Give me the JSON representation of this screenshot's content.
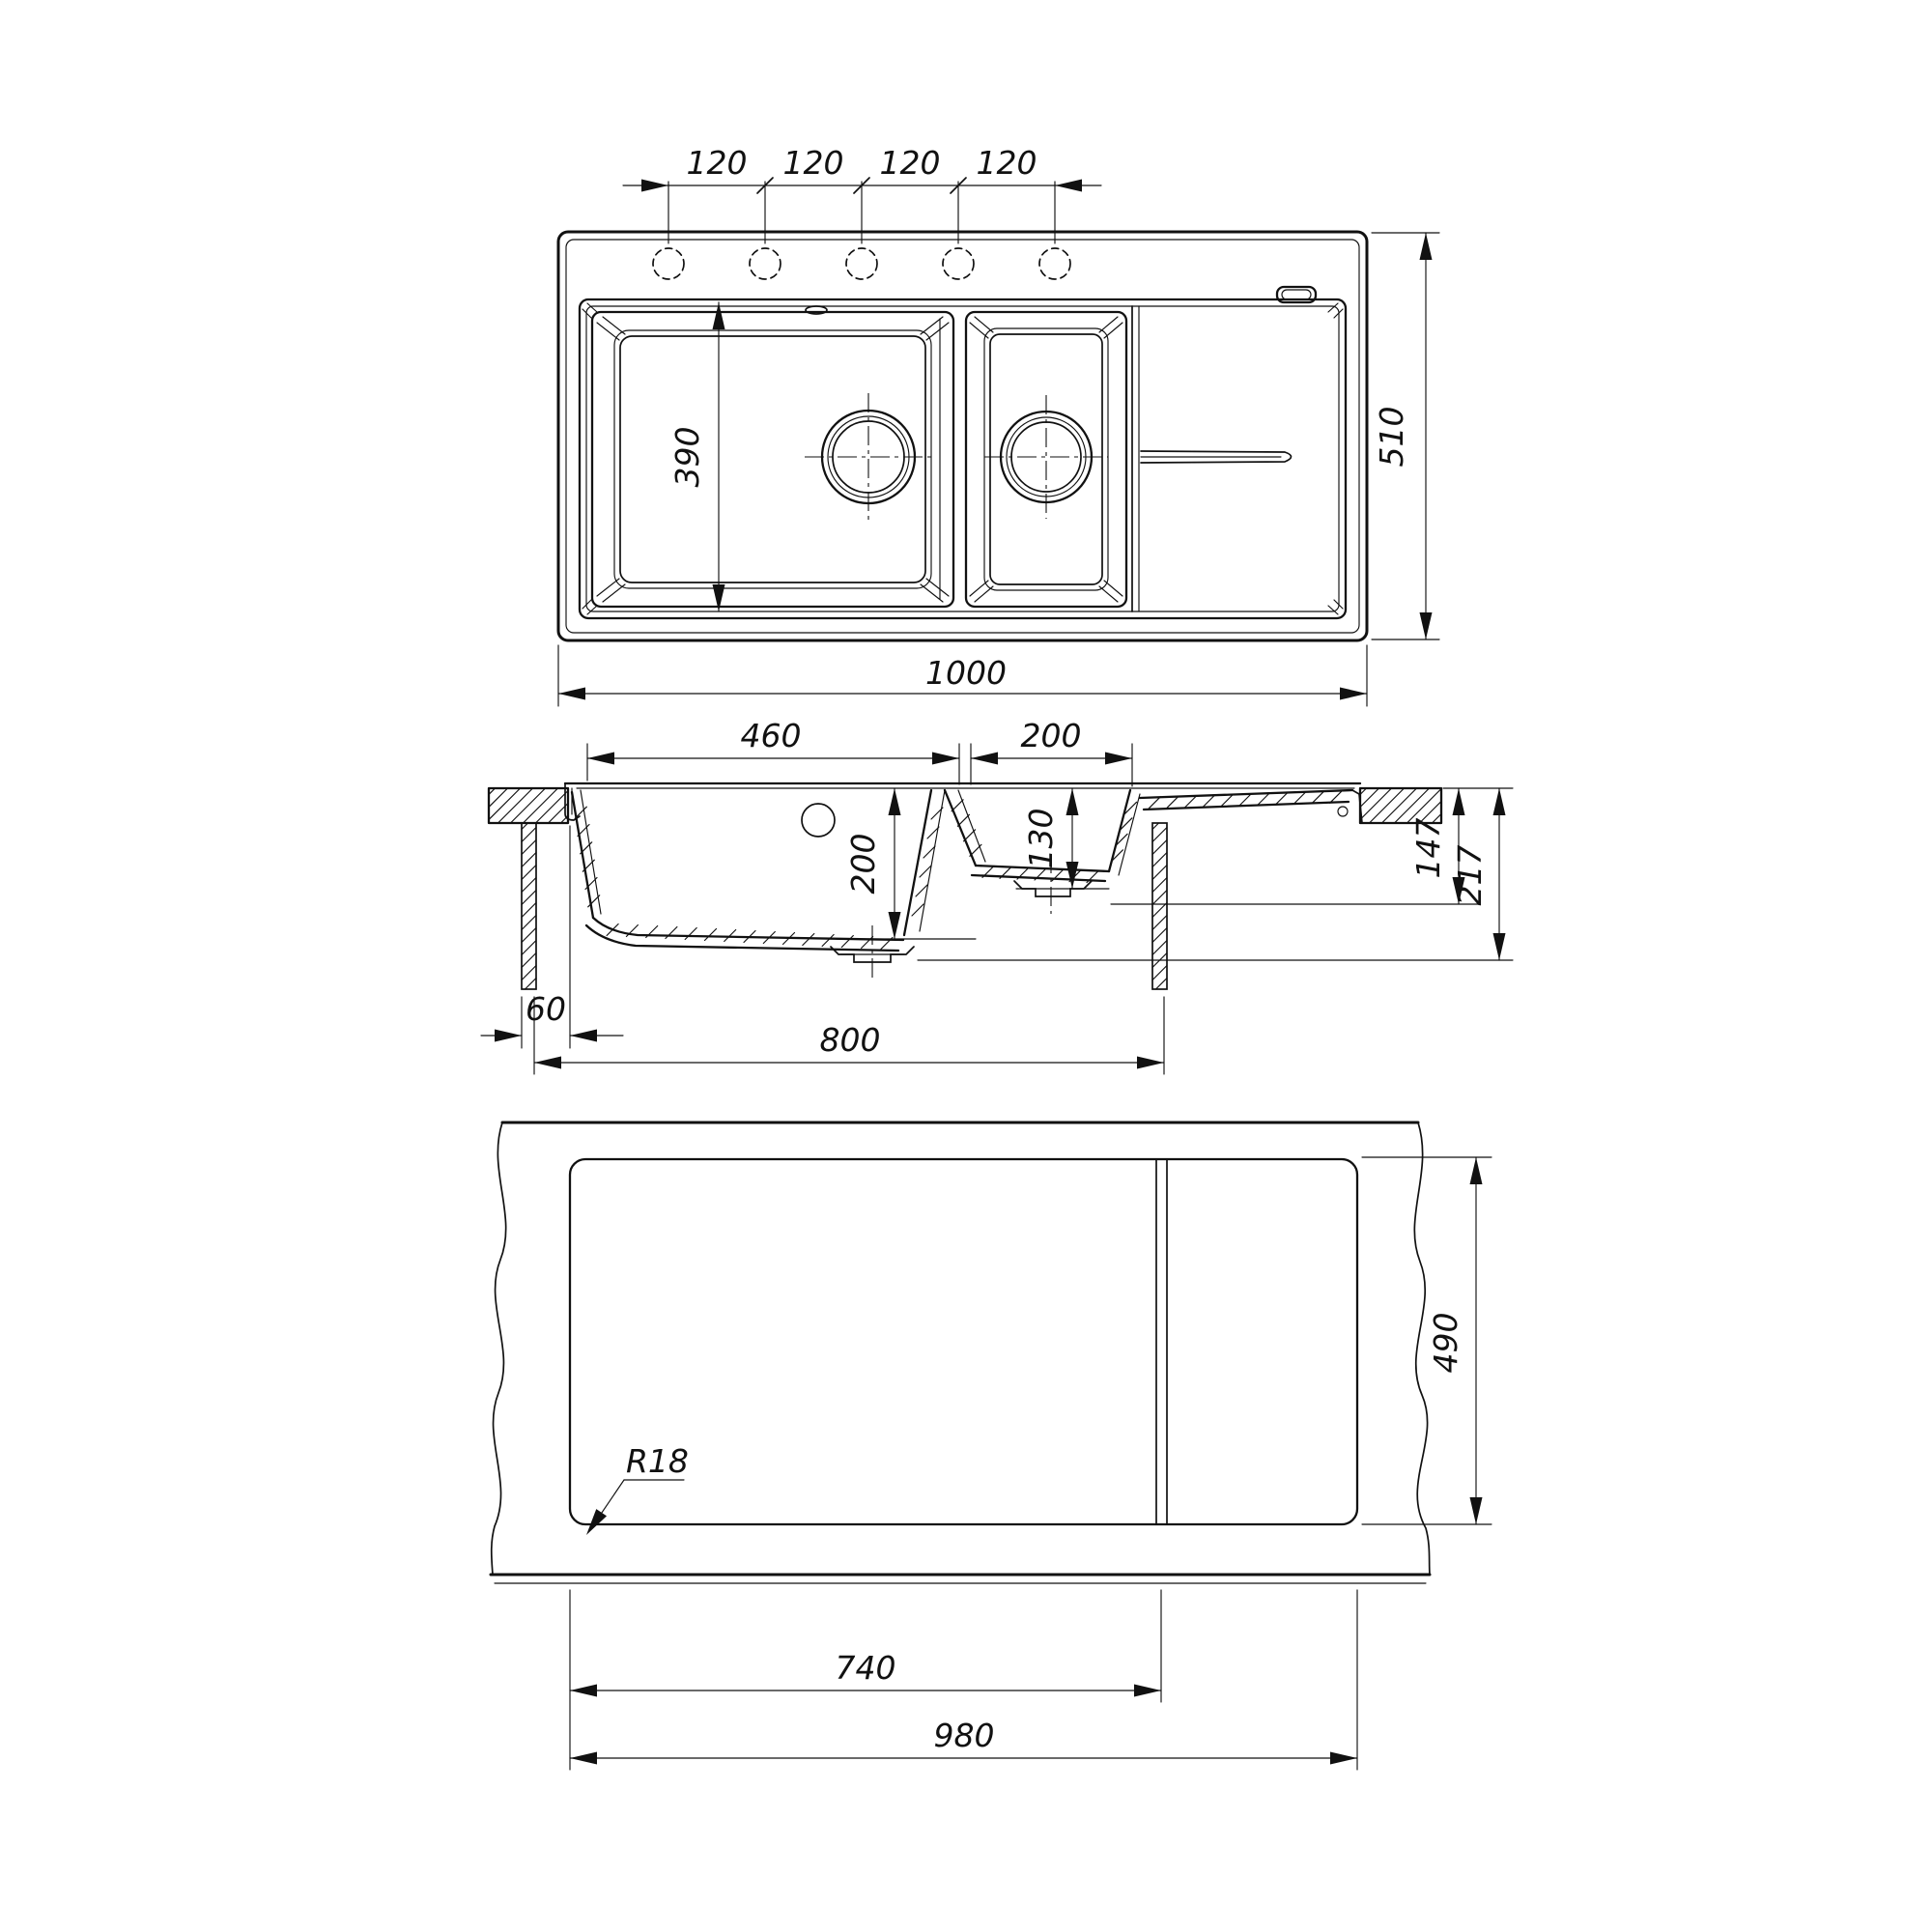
{
  "colors": {
    "line": "#111111",
    "background": "#ffffff"
  },
  "views": {
    "top": {
      "hole_spacings": [
        "120",
        "120",
        "120",
        "120"
      ],
      "overall_width": "1000",
      "overall_depth": "510",
      "bowl_inner_length": "390"
    },
    "section": {
      "main_bowl_width": "460",
      "small_bowl_width": "200",
      "main_bowl_depth": "200",
      "small_bowl_depth": "130",
      "front_overhang": "60",
      "cabinet_width": "800",
      "height_to_drainboard": "147",
      "overall_height": "217"
    },
    "bottom": {
      "cutout_depth": "490",
      "divider_offset": "740",
      "cutout_width": "980",
      "corner_radius": "R18"
    }
  }
}
